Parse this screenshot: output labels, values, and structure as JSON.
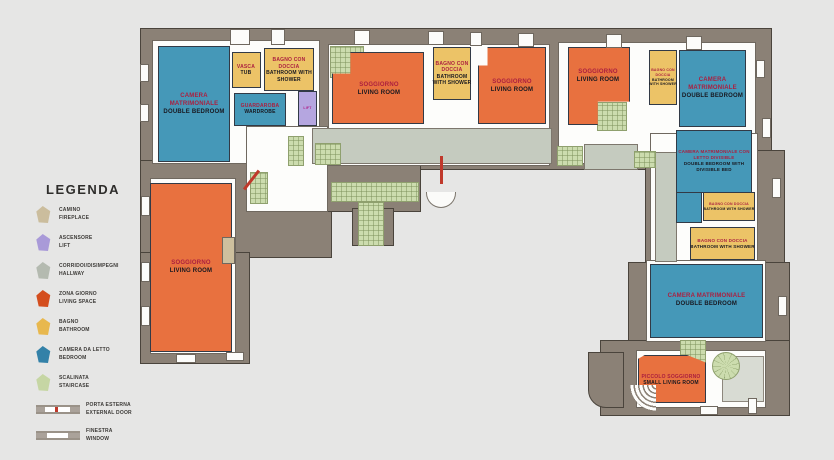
{
  "legend": {
    "title": "LEGENDA",
    "items": [
      {
        "id": "camino",
        "it": "CAMINO",
        "en": "FIREPLACE",
        "color": "#cbbd9d"
      },
      {
        "id": "ascensore",
        "it": "ASCENSORE",
        "en": "LIFT",
        "color": "#a99ad8"
      },
      {
        "id": "corridoi",
        "it": "CORRIDOI/DISIMPEGNI",
        "en": "HALLWAY",
        "color": "#b4bab0"
      },
      {
        "id": "zona-giorno",
        "it": "ZONA GIORNO",
        "en": "LIVING SPACE",
        "color": "#d44e1e"
      },
      {
        "id": "bagno",
        "it": "BAGNO",
        "en": "BATHROOM",
        "color": "#e8b84e"
      },
      {
        "id": "camera",
        "it": "CAMERA DA LETTO",
        "en": "BEDROOM",
        "color": "#3381a8"
      },
      {
        "id": "scalinata",
        "it": "SCALINATA",
        "en": "STAIRCASE",
        "color": "#c6d6a4"
      }
    ],
    "symbols": [
      {
        "id": "porta-esterna",
        "it": "PORTA ESTERNA",
        "en": "EXTERNAL DOOR"
      },
      {
        "id": "finestra",
        "it": "FINESTRA",
        "en": "WINDOW"
      }
    ]
  },
  "rooms": {
    "bedroom_tl": {
      "it": "CAMERA MATRIMONIALE",
      "en": "DOUBLE BEDROOM"
    },
    "vasca": {
      "it": "VASCA",
      "en": "TUB"
    },
    "bagno_tl": {
      "it": "BAGNO CON DOCCIA",
      "en": "BATHROOM WITH SHOWER"
    },
    "guardaroba": {
      "it": "GUARDAROBA",
      "en": "WARDROBE"
    },
    "lift": {
      "en": "LIFT"
    },
    "sogg_m1": {
      "it": "SOGGIORNO",
      "en": "LIVING ROOM"
    },
    "bagno_mc": {
      "it": "BAGNO CON DOCCIA",
      "en": "BATHROOM WITH SHOWER"
    },
    "sogg_m2": {
      "it": "SOGGIORNO",
      "en": "LIVING ROOM"
    },
    "sogg_m3": {
      "it": "SOGGIORNO",
      "en": "LIVING ROOM"
    },
    "bagno_tr": {
      "it": "BAGNO CON DOCCIA",
      "en": "BATHROOM WITH SHOWER"
    },
    "bedroom_tr": {
      "it": "CAMERA MATRIMONIALE",
      "en": "DOUBLE BEDROOM"
    },
    "bedroom_div": {
      "it": "CAMERA MATRIMONIALE CON LETTO DIVISIBLE",
      "en": "DOUBLE BEDROOM WITH DIVISIBLE BED"
    },
    "bagno_r1": {
      "it": "BAGNO CON DOCCIA",
      "en": "BATHROOM WITH SHOWER"
    },
    "bagno_r2": {
      "it": "BAGNO CON DOCCIA",
      "en": "BATHROOM WITH SHOWER"
    },
    "bedroom_br": {
      "it": "CAMERA MATRIMONIALE",
      "en": "DOUBLE BEDROOM"
    },
    "piccolo": {
      "it": "PICCOLO SOGGIORNO",
      "en": "SMALL LIVING ROOM"
    },
    "sogg_left": {
      "it": "SOGGIORNO",
      "en": "LIVING ROOM"
    }
  },
  "colors": {
    "background": "#e6e6e5",
    "wall": "#8b8176",
    "floor": "#fdfdfb",
    "hallway": "#c5cbbf",
    "bedroom": "#4598b8",
    "living_space": "#e8713f",
    "bathroom": "#ecc367",
    "lift": "#b5a6e0",
    "staircase": "#ccdcae",
    "fireplace": "#cec09e",
    "door_marker": "#c0392b",
    "label_italian": "#ab1f3f",
    "label_english": "#181820"
  }
}
